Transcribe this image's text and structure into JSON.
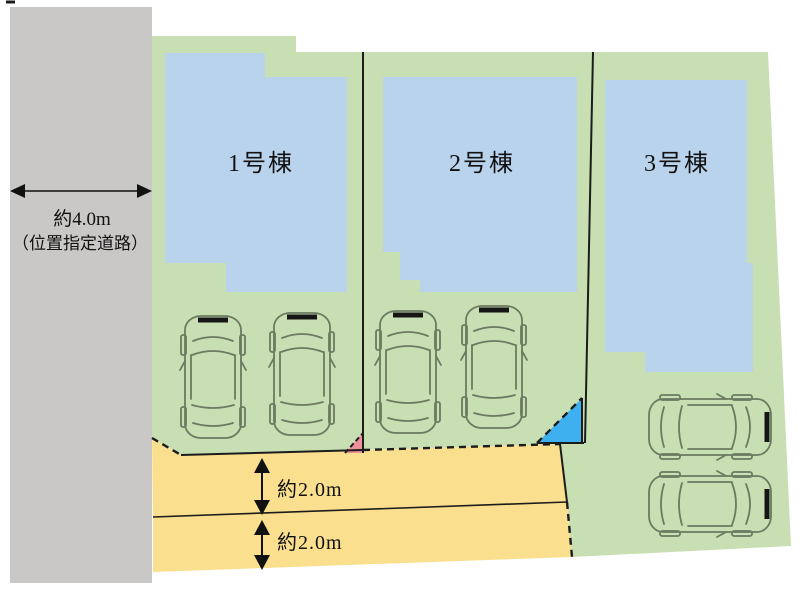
{
  "plan": {
    "left_road": {
      "width_label": "約4.0m",
      "type_label": "（位置指定道路）"
    },
    "lots": [
      {
        "building_label": "1号棟"
      },
      {
        "building_label": "2号棟"
      },
      {
        "building_label": "3号棟"
      }
    ],
    "bottom_roads": {
      "upper_width_label": "約2.0m",
      "lower_width_label": "約2.0m"
    },
    "colors": {
      "road_gray": "#c9c8c6",
      "lot_green": "#c8dfb4",
      "building_blue": "#b9d3ec",
      "road_yellow": "#fadf8f",
      "corner_pink": "#ee8f9c",
      "corner_blue": "#3eb0f0",
      "line_dark": "#1c1c1c"
    }
  }
}
